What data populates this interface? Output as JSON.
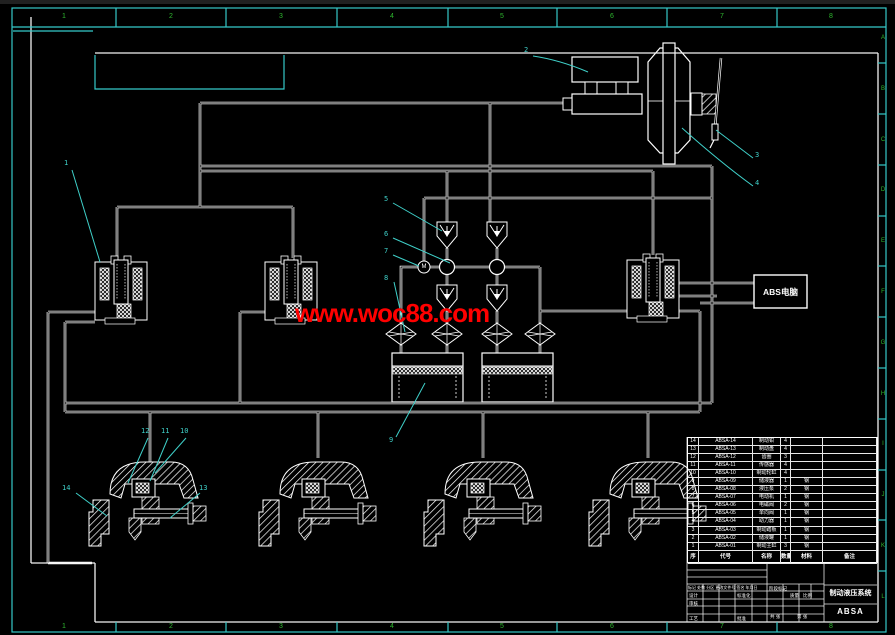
{
  "drawing": {
    "title": "制动液压系统",
    "drawing_no": "ABSA",
    "ecu_label": "ABS电脑",
    "motor_label": "M",
    "watermark": "www.woc88.com"
  },
  "colors": {
    "background": "#000000",
    "line": "#ffffff",
    "border_cyan": "#35c9c9",
    "zone_green": "#2eb82e",
    "leader_cyan": "#3fd0c9",
    "watermark_red": "#ff0000"
  },
  "border": {
    "zone_columns": [
      "1",
      "2",
      "3",
      "4",
      "5",
      "6",
      "7",
      "8"
    ],
    "zone_rows": [
      "A",
      "B",
      "C",
      "D",
      "E",
      "F",
      "G",
      "H",
      "I",
      "J",
      "K",
      "L"
    ]
  },
  "callouts": [
    {
      "t": "1",
      "x": 64,
      "y": 160
    },
    {
      "t": "2",
      "x": 524,
      "y": 47
    },
    {
      "t": "3",
      "x": 755,
      "y": 152
    },
    {
      "t": "4",
      "x": 755,
      "y": 180
    },
    {
      "t": "5",
      "x": 384,
      "y": 196
    },
    {
      "t": "6",
      "x": 384,
      "y": 231
    },
    {
      "t": "7",
      "x": 384,
      "y": 248
    },
    {
      "t": "8",
      "x": 384,
      "y": 275
    },
    {
      "t": "9",
      "x": 389,
      "y": 437
    },
    {
      "t": "10",
      "x": 180,
      "y": 428
    },
    {
      "t": "11",
      "x": 161,
      "y": 428
    },
    {
      "t": "12",
      "x": 141,
      "y": 428
    },
    {
      "t": "13",
      "x": 199,
      "y": 485
    },
    {
      "t": "14",
      "x": 62,
      "y": 485
    }
  ],
  "bom": {
    "headers": [
      "序",
      "代号",
      "名称",
      "数量",
      "材料",
      "备注"
    ],
    "rows": [
      {
        "no": "14",
        "code": "ABSA-14",
        "name": "制动钳",
        "qty": "4",
        "mat": "",
        "note": ""
      },
      {
        "no": "13",
        "code": "ABSA-13",
        "name": "制动盘",
        "qty": "4",
        "mat": "",
        "note": ""
      },
      {
        "no": "12",
        "code": "ABSA-12",
        "name": "齿圈",
        "qty": "3",
        "mat": "",
        "note": ""
      },
      {
        "no": "11",
        "code": "ABSA-11",
        "name": "传感器",
        "qty": "4",
        "mat": "",
        "note": ""
      },
      {
        "no": "10",
        "code": "ABSA-10",
        "name": "制动轮缸",
        "qty": "4",
        "mat": "",
        "note": ""
      },
      {
        "no": "9",
        "code": "ABSA-09",
        "name": "储液器",
        "qty": "1",
        "mat": "钢",
        "note": ""
      },
      {
        "no": "8",
        "code": "ABSA-08",
        "name": "液压泵",
        "qty": "2",
        "mat": "钢",
        "note": ""
      },
      {
        "no": "7",
        "code": "ABSA-07",
        "name": "电动机",
        "qty": "1",
        "mat": "钢",
        "note": ""
      },
      {
        "no": "6",
        "code": "ABSA-06",
        "name": "电磁阀",
        "qty": "2",
        "mat": "钢",
        "note": ""
      },
      {
        "no": "5",
        "code": "ABSA-05",
        "name": "单向阀",
        "qty": "1",
        "mat": "钢",
        "note": ""
      },
      {
        "no": "4",
        "code": "ABSA-04",
        "name": "助力器",
        "qty": "1",
        "mat": "钢",
        "note": ""
      },
      {
        "no": "3",
        "code": "ABSA-03",
        "name": "制动踏板",
        "qty": "1",
        "mat": "钢",
        "note": ""
      },
      {
        "no": "2",
        "code": "ABSA-02",
        "name": "储液罐",
        "qty": "1",
        "mat": "钢",
        "note": ""
      },
      {
        "no": "1",
        "code": "ABSA-01",
        "name": "制动主缸",
        "qty": "3",
        "mat": "钢",
        "note": ""
      }
    ]
  },
  "titleblock": {
    "rev_row": "标记 处数 分区 更改文件号 签名 年月日",
    "design": "设计",
    "standard": "标准化",
    "stage": "阶段标记",
    "weight": "质量",
    "scale": "比例",
    "audit": "审核",
    "process": "工艺",
    "approve": "批准",
    "sheets": "共 张",
    "sheet": "第 张"
  }
}
